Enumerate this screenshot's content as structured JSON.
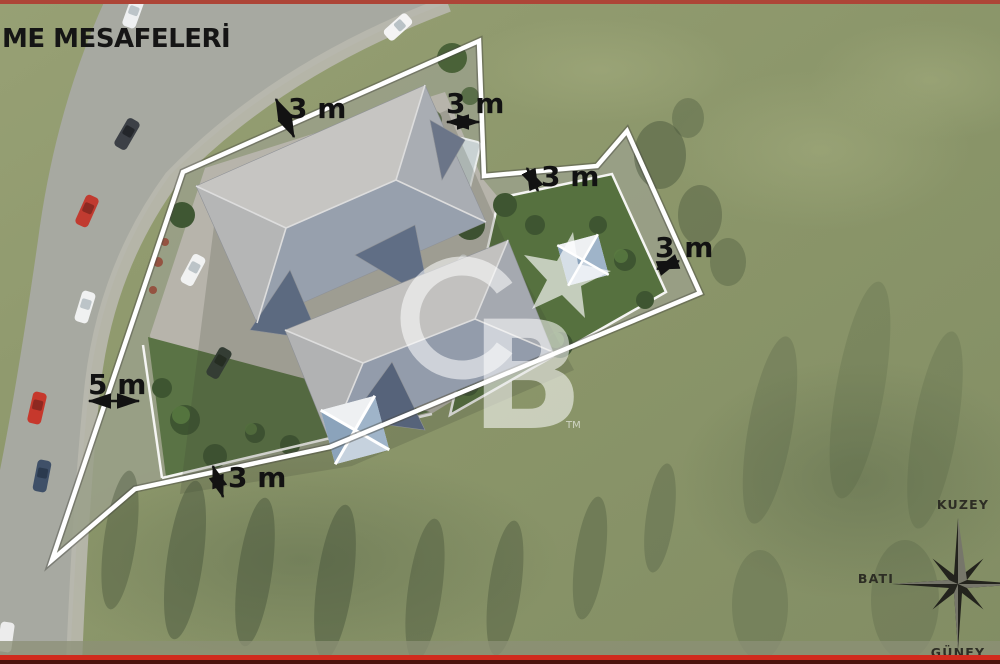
{
  "title": "ME MESAFELERİ",
  "setbacks": {
    "top_left": "3 m",
    "top_notch": "3 m",
    "mid_notch": "3 m",
    "right_side": "3 m",
    "road_side": "5 m",
    "bottom": "3 m"
  },
  "compass": {
    "north": "KUZEY",
    "west": "BATI",
    "south": "GÜNEY"
  },
  "watermark": {
    "letter_b": "B",
    "tm": "TM"
  },
  "colors": {
    "top_bar": "#ad4537",
    "bottom_bar": "#d02b1d",
    "bottom_bar_edge": "#4a120c",
    "boundary_line": "#ffffff",
    "label_ink": "#121212",
    "grass": "#8b956c",
    "road": "#a7a9a1",
    "roof_light": "#c6c5c2",
    "roof_slate": "#5c6a80",
    "garden_green": "#56713f"
  }
}
